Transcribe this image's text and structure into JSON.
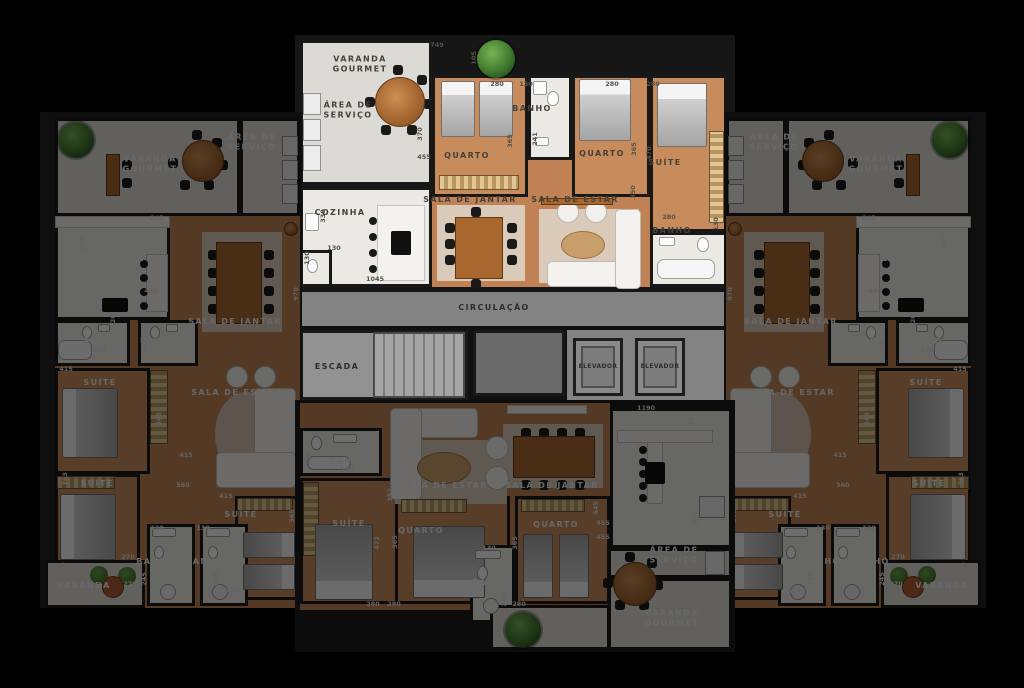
{
  "palette": {
    "background": "#000000",
    "highlight_wood": "#c88c5c",
    "highlight_marble": "#ebe9e3",
    "dimmed_filter_brightness": "0.44",
    "core_gray": "#838383",
    "table_wood": "#a8672f",
    "rug_beige": "#d9caba"
  },
  "core": {
    "circulacao": "CIRCULAÇÃO",
    "escada": "ESCADA",
    "elevador_1": "ELEVADOR",
    "elevador_2": "ELEVADOR"
  },
  "apartments": {
    "top": {
      "state": "highlighted",
      "rooms": {
        "varanda_gourmet": "VARANDA\nGOURMET",
        "area_servico": "ÁREA DE\nSERVIÇO",
        "cozinha": "COZINHA",
        "quarto_1": "QUARTO",
        "banho_1": "BANHO",
        "quarto_2": "QUARTO",
        "suite": "SUÍTE",
        "sala_jantar": "SALA DE JANTAR",
        "sala_estar": "SALA DE ESTAR",
        "banho_suite": "BANHO"
      },
      "dims": [
        "749",
        "105",
        "370",
        "455",
        "330",
        "130",
        "130",
        "1045",
        "280",
        "130",
        "241",
        "365",
        "280",
        "280",
        "470",
        "365",
        "350",
        "280",
        "130"
      ]
    },
    "left": {
      "state": "dimmed",
      "rooms": {
        "varanda_gourmet": "VARANDA\nGOURMET",
        "area_servico": "ÁREA DE\nSERVIÇO",
        "cozinha": "COZINHA",
        "sala_jantar": "SALA DE JANTAR",
        "banho_social": "BANHO",
        "lavabo": "LAVABO",
        "suite_1": "SUÍTE",
        "sala_estar": "SALA DE ESTAR",
        "suite_2": "SUÍTE",
        "suite_3": "SUÍTE",
        "banho_1": "BANHO",
        "banho_2": "BANHO",
        "varanda": "VARANDA"
      },
      "dims": [
        "845",
        "319",
        "845",
        "350",
        "430",
        "970",
        "120",
        "270",
        "130",
        "130",
        "415",
        "345",
        "363",
        "415",
        "560",
        "415",
        "365",
        "130",
        "130",
        "245",
        "245",
        "270",
        "270",
        "105",
        "270"
      ]
    },
    "right": {
      "state": "dimmed",
      "rooms": {
        "varanda_gourmet": "VARANDA\nGOURMET",
        "area_servico": "ÁREA DE\nSERVIÇO",
        "cozinha": "COZINHA",
        "sala_jantar": "SALA DE JANTAR",
        "banho_social": "BANHO",
        "lavabo": "LAVABO",
        "suite_1": "SUÍTE",
        "sala_estar": "SALA DE ESTAR",
        "suite_2": "SUÍTE",
        "suite_3": "SUÍTE",
        "banho_1": "BANHO",
        "banho_2": "BANHO",
        "varanda": "VARANDA"
      },
      "dims": [
        "845",
        "319",
        "845",
        "350",
        "430",
        "970",
        "120",
        "270",
        "130",
        "130",
        "415",
        "345",
        "363",
        "415",
        "560",
        "415",
        "365",
        "130",
        "130",
        "245",
        "245",
        "270",
        "270",
        "105",
        "270"
      ]
    },
    "bottom": {
      "state": "dimmed",
      "rooms": {
        "banho_suite": "BANHO",
        "suite": "SUÍTE",
        "sala_estar": "SALA DE ESTAR",
        "quarto_1": "QUARTO",
        "sala_jantar": "SALA DE JANTAR",
        "quarto_2": "QUARTO",
        "banho_social": "BANHO",
        "cozinha": "COZINHA",
        "area_servico": "ÁREA DE\nSERVIÇO",
        "varanda_gourmet": "VARANDA\nGOURMET"
      },
      "dims": [
        "130",
        "280",
        "472",
        "280",
        "352",
        "365",
        "280",
        "365",
        "280",
        "130",
        "240",
        "1190",
        "93",
        "337",
        "445",
        "455",
        "455",
        "392",
        "749",
        "105"
      ]
    }
  }
}
